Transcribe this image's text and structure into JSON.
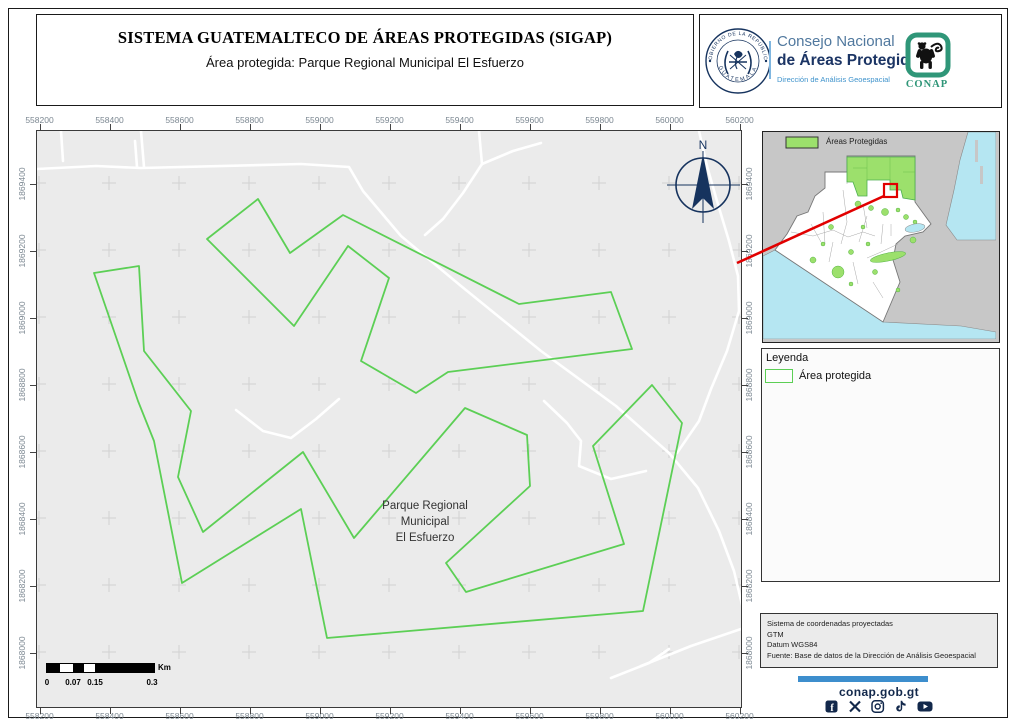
{
  "header": {
    "title": "SISTEMA GUATEMALTECO DE ÁREAS PROTEGIDAS  (SIGAP)",
    "subtitle": "Área protegida: Parque Regional Municipal El Esfuerzo"
  },
  "branding": {
    "seal_text_top": "GOBIERNO DE LA REPÚBLICA",
    "seal_text_bottom": "GUATEMALA",
    "org_line1": "Consejo Nacional",
    "org_line2": "de Áreas Protegidas",
    "org_line3": "Dirección de Análisis Geoespacial",
    "conap_wordmark": "CONAP"
  },
  "map": {
    "north_label": "N",
    "park_label_lines": [
      "Parque Regional",
      "Municipal",
      "El Esfuerzo"
    ],
    "x_ticks": [
      "558200",
      "558400",
      "558600",
      "558800",
      "559000",
      "559200",
      "559400",
      "559600",
      "559800",
      "560000",
      "560200"
    ],
    "y_ticks": [
      "1869400",
      "1869200",
      "1869000",
      "1868800",
      "1868600",
      "1868400",
      "1868200",
      "1868000"
    ]
  },
  "scalebar": {
    "labels": [
      "0",
      "0.07",
      "0.15",
      "0.3"
    ],
    "unit": "Km"
  },
  "overview": {
    "legend_label": "Áreas Protegidas"
  },
  "legend": {
    "title": "Leyenda",
    "item_label": "Área protegida"
  },
  "info": {
    "lines": [
      "Sistema de coordenadas proyectadas",
      "GTM",
      "Datum WGS84",
      "Fuente: Base de datos de la Dirección de Análisis Geoespacial"
    ]
  },
  "footer": {
    "website": "conap.gob.gt",
    "social_icons": [
      "facebook",
      "x-twitter",
      "instagram",
      "tiktok",
      "youtube"
    ]
  },
  "colors": {
    "park_green": "#5ccf55",
    "navy": "#16335e",
    "light_blue": "#3f93cc",
    "conap_teal": "#2f9678",
    "red": "#e10000",
    "water_cyan": "#b5e6f2",
    "protected_fill": "#9ce06c",
    "footer_bar_blue": "#3d8ecd",
    "map_background": "#ebebeb"
  },
  "map_geometry": {
    "grid_x": [
      2,
      72,
      142,
      212,
      282,
      352,
      422,
      492,
      562,
      632,
      702
    ],
    "grid_y": [
      52,
      119,
      186,
      253,
      320,
      387,
      454,
      521
    ],
    "ring1": [
      [
        170,
        108
      ],
      [
        221,
        68
      ],
      [
        253,
        122
      ],
      [
        306,
        84
      ],
      [
        482,
        173
      ],
      [
        574,
        161
      ],
      [
        595,
        218
      ],
      [
        411,
        241
      ],
      [
        379,
        262
      ],
      [
        324,
        230
      ],
      [
        352,
        147
      ],
      [
        311,
        115
      ],
      [
        257,
        195
      ]
    ],
    "ring2": [
      [
        57,
        142
      ],
      [
        102,
        135
      ],
      [
        107,
        220
      ],
      [
        154,
        280
      ],
      [
        141,
        346
      ],
      [
        166,
        401
      ],
      [
        266,
        321
      ],
      [
        317,
        407
      ],
      [
        428,
        277
      ],
      [
        490,
        304
      ],
      [
        493,
        355
      ],
      [
        409,
        432
      ],
      [
        429,
        461
      ],
      [
        587,
        413
      ],
      [
        556,
        315
      ],
      [
        615,
        254
      ],
      [
        645,
        292
      ],
      [
        606,
        480
      ],
      [
        290,
        507
      ],
      [
        264,
        378
      ],
      [
        145,
        452
      ],
      [
        117,
        310
      ],
      [
        101,
        270
      ]
    ],
    "roads": [
      [
        [
          0,
          38
        ],
        [
          59,
          35
        ],
        [
          104,
          37
        ],
        [
          264,
          33
        ],
        [
          312,
          36
        ],
        [
          326,
          60
        ],
        [
          364,
          105
        ],
        [
          424,
          155
        ],
        [
          504,
          220
        ],
        [
          579,
          275
        ],
        [
          632,
          322
        ],
        [
          661,
          357
        ],
        [
          682,
          400
        ],
        [
          697,
          440
        ],
        [
          706,
          478
        ]
      ],
      [
        [
          24,
          0
        ],
        [
          26,
          30
        ]
      ],
      [
        [
          104,
          0
        ],
        [
          107,
          36
        ]
      ],
      [
        [
          98,
          10
        ],
        [
          100,
          36
        ]
      ],
      [
        [
          442,
          0
        ],
        [
          445,
          33
        ],
        [
          426,
          62
        ],
        [
          406,
          88
        ],
        [
          388,
          104
        ]
      ],
      [
        [
          445,
          33
        ],
        [
          476,
          20
        ],
        [
          504,
          12
        ]
      ],
      [
        [
          662,
          0
        ],
        [
          670,
          35
        ],
        [
          680,
          70
        ],
        [
          692,
          110
        ],
        [
          701,
          145
        ],
        [
          702,
          180
        ],
        [
          690,
          220
        ],
        [
          674,
          258
        ],
        [
          662,
          290
        ],
        [
          640,
          322
        ]
      ],
      [
        [
          507,
          270
        ],
        [
          530,
          292
        ],
        [
          544,
          310
        ],
        [
          542,
          335
        ],
        [
          574,
          348
        ],
        [
          609,
          340
        ]
      ],
      [
        [
          199,
          279
        ],
        [
          226,
          300
        ],
        [
          254,
          307
        ],
        [
          279,
          288
        ],
        [
          302,
          268
        ]
      ],
      [
        [
          604,
          535
        ],
        [
          654,
          515
        ],
        [
          704,
          498
        ]
      ],
      [
        [
          574,
          547
        ],
        [
          612,
          532
        ],
        [
          632,
          518
        ]
      ]
    ]
  }
}
